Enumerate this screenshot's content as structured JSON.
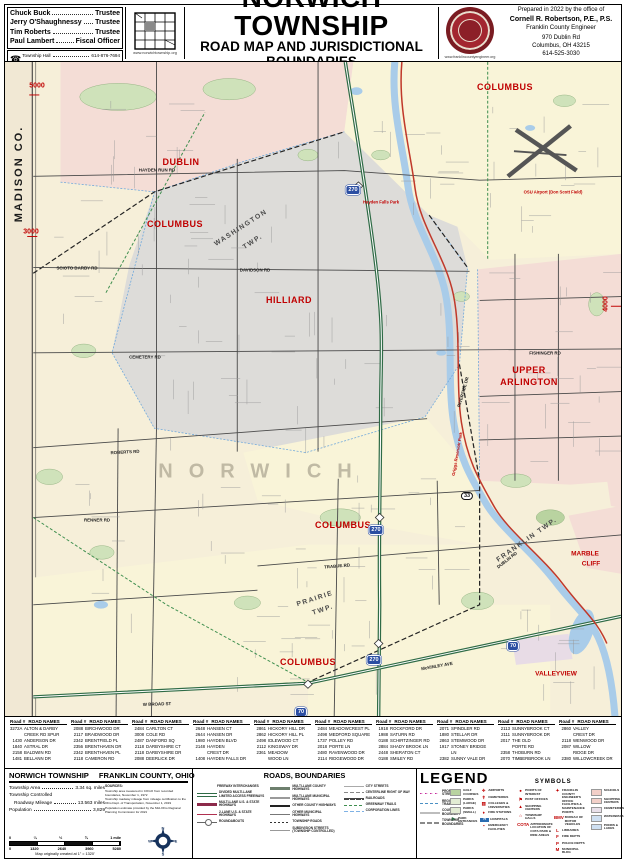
{
  "header": {
    "officials": [
      {
        "name": "Chuck Buck",
        "role": "Trustee"
      },
      {
        "name": "Jerry O'Shaughnessy",
        "role": "Trustee"
      },
      {
        "name": "Tim Roberts",
        "role": "Trustee"
      },
      {
        "name": "Paul Lambert",
        "role": "Fiscal Officer"
      }
    ],
    "contacts": [
      {
        "label": "Township Hall",
        "phone": "614-876-7694"
      },
      {
        "label": "Road Superintendent",
        "phone": "614-876-2238"
      }
    ],
    "phone_icon": "☎",
    "township_site": "www.norwichtownship.org",
    "title": "NORWICH TOWNSHIP",
    "subtitle": "ROAD MAP AND JURISDICTIONAL BOUNDARIES",
    "established": "-  ESTABLISHED 1813  -",
    "prepared": {
      "line1": "Prepared in 2022 by the office of",
      "name": "Cornell R. Robertson, P.E., P.S.",
      "org": "Franklin County Engineer",
      "addr1": "970 Dublin Rd",
      "addr2": "Columbus, OH  43215",
      "phone": "614-525-3030",
      "site": "www.franklincountyengineer.org",
      "seal_text": "FRANKLIN COUNTY ENGINEER"
    }
  },
  "map": {
    "labels": [
      {
        "text": "MADISON CO.",
        "x": 14,
        "y": 112,
        "rot": -90,
        "cls": "county"
      },
      {
        "text": "5000",
        "x": 32,
        "y": 24,
        "cls": "marker"
      },
      {
        "text": "3000",
        "x": 26,
        "y": 170,
        "cls": "marker"
      },
      {
        "text": "4000",
        "x": 601,
        "y": 242,
        "rot": -90,
        "cls": "marker"
      },
      {
        "text": "DUBLIN",
        "x": 176,
        "y": 100,
        "cls": "city"
      },
      {
        "text": "COLUMBUS",
        "x": 170,
        "y": 162,
        "cls": "city"
      },
      {
        "text": "WASHINGTON",
        "x": 236,
        "y": 166,
        "rot": -33,
        "cls": "twp"
      },
      {
        "text": "TWP.",
        "x": 248,
        "y": 180,
        "rot": -33,
        "cls": "twp"
      },
      {
        "text": "COLUMBUS",
        "x": 500,
        "y": 25,
        "cls": "city"
      },
      {
        "text": "HILLIARD",
        "x": 284,
        "y": 238,
        "cls": "city"
      },
      {
        "text": "UPPER",
        "x": 524,
        "y": 308,
        "cls": "city"
      },
      {
        "text": "ARLINGTON",
        "x": 524,
        "y": 320,
        "cls": "city"
      },
      {
        "text": "NORWICH",
        "x": 258,
        "y": 410,
        "cls": "norwich"
      },
      {
        "text": "COLUMBUS",
        "x": 338,
        "y": 463,
        "cls": "city"
      },
      {
        "text": "PRAIRIE",
        "x": 310,
        "y": 537,
        "rot": -18,
        "cls": "twp"
      },
      {
        "text": "TWP.",
        "x": 318,
        "y": 548,
        "rot": -18,
        "cls": "twp"
      },
      {
        "text": "FRANKLIN TWP.",
        "x": 522,
        "y": 478,
        "rot": -35,
        "cls": "twp"
      },
      {
        "text": "COLUMBUS",
        "x": 303,
        "y": 600,
        "cls": "city"
      },
      {
        "text": "MARBLE",
        "x": 580,
        "y": 492,
        "cls": "city-sm"
      },
      {
        "text": "CLIFF",
        "x": 586,
        "y": 502,
        "cls": "city-sm"
      },
      {
        "text": "VALLEYVIEW",
        "x": 551,
        "y": 612,
        "cls": "city-sm"
      },
      {
        "text": "HAYDEN RUN RD",
        "x": 152,
        "y": 108,
        "cls": "road"
      },
      {
        "text": "DAVIDSON RD",
        "x": 250,
        "y": 208,
        "cls": "road"
      },
      {
        "text": "SCIOTO DARBY RD",
        "x": 72,
        "y": 206,
        "cls": "road"
      },
      {
        "text": "CEMETERY RD",
        "x": 140,
        "y": 295,
        "cls": "road"
      },
      {
        "text": "FISHINGER RD",
        "x": 540,
        "y": 291,
        "cls": "road"
      },
      {
        "text": "ROBERTS RD",
        "x": 120,
        "y": 390,
        "rot": -3,
        "cls": "road"
      },
      {
        "text": "RENNER RD",
        "x": 92,
        "y": 458,
        "cls": "road"
      },
      {
        "text": "TRABUE RD",
        "x": 332,
        "y": 504,
        "rot": -5,
        "cls": "road"
      },
      {
        "text": "RIVERSIDE DR",
        "x": 458,
        "y": 330,
        "rot": -74,
        "cls": "road"
      },
      {
        "text": "DUBLIN RD",
        "x": 502,
        "y": 498,
        "rot": -38,
        "cls": "road"
      },
      {
        "text": "McKINLEY AVE",
        "x": 432,
        "y": 604,
        "rot": -10,
        "cls": "road"
      },
      {
        "text": "W BROAD ST",
        "x": 152,
        "y": 642,
        "rot": -2,
        "cls": "road"
      },
      {
        "text": "Hayden Falls Park",
        "x": 376,
        "y": 140,
        "cls": "poi"
      },
      {
        "text": "Griggs Reservoir Park",
        "x": 452,
        "y": 392,
        "rot": -80,
        "cls": "poi"
      },
      {
        "text": "OSU Airport (Don Scott Field)",
        "x": 548,
        "y": 130,
        "cls": "poi"
      },
      {
        "text": "270",
        "x": 348,
        "y": 128,
        "cls": "shield"
      },
      {
        "text": "270",
        "x": 371,
        "y": 468,
        "cls": "shield"
      },
      {
        "text": "270",
        "x": 369,
        "y": 598,
        "cls": "shield"
      },
      {
        "text": "70",
        "x": 296,
        "y": 650,
        "cls": "shield"
      },
      {
        "text": "70",
        "x": 508,
        "y": 584,
        "cls": "shield"
      },
      {
        "text": "33",
        "x": 462,
        "y": 434,
        "cls": "shield-st"
      }
    ]
  },
  "roads": {
    "head_num": "Road #",
    "head_name": "ROAD NAMES",
    "columns": [
      {
        "rows": [
          {
            "n": "3272A",
            "r": "ALTON & DARBY"
          },
          {
            "n": "",
            "r": "CREEK RD SPUR"
          },
          {
            "n": "1430",
            "r": "ANDERSON DR"
          },
          {
            "n": "1840",
            "r": "ASTRAL DR"
          },
          {
            "n": "2158",
            "r": "BALDWIN RD"
          },
          {
            "n": "1481",
            "r": "BELLANN DR"
          }
        ]
      },
      {
        "rows": [
          {
            "n": "2088",
            "r": "BIRCHWOOD DR"
          },
          {
            "n": "2117",
            "r": "BRAIDWOOD DR"
          },
          {
            "n": "2342",
            "r": "BRENTFIELD PL"
          },
          {
            "n": "2356",
            "r": "BRENTHAVEN DR"
          },
          {
            "n": "2342",
            "r": "BRENTHAVEN PL"
          },
          {
            "n": "2118",
            "r": "CAMERON RD"
          }
        ]
      },
      {
        "rows": [
          {
            "n": "2484",
            "r": "CARLTON CT"
          },
          {
            "n": "3008",
            "r": "COLE RD"
          },
          {
            "n": "2487",
            "r": "DANFORD SQ"
          },
          {
            "n": "2118",
            "r": "DARBYSHIRE CT"
          },
          {
            "n": "2118",
            "r": "DARBYSHIRE DR"
          },
          {
            "n": "2088",
            "r": "DEERLICK DR"
          }
        ]
      },
      {
        "rows": [
          {
            "n": "2648",
            "r": "HANSEN CT"
          },
          {
            "n": "2644",
            "r": "HANSEN DR"
          },
          {
            "n": "1980",
            "r": "HAYDEN BLVD"
          },
          {
            "n": "2148",
            "r": "HAYDEN"
          },
          {
            "n": "",
            "r": "CREST DR"
          },
          {
            "n": "1408",
            "r": "HAYDEN FALLS DR"
          }
        ]
      },
      {
        "rows": [
          {
            "n": "2861",
            "r": "HICKORY HILL DR"
          },
          {
            "n": "2862",
            "r": "HICKORY HILL PL"
          },
          {
            "n": "2498",
            "r": "IDLEWOOD CT"
          },
          {
            "n": "2112",
            "r": "KINGSWAY DR"
          },
          {
            "n": "2361",
            "r": "MEADOW"
          },
          {
            "n": "",
            "r": "WOOD LN"
          }
        ]
      },
      {
        "rows": [
          {
            "n": "2484",
            "r": "MEADOWCREST PL"
          },
          {
            "n": "2498",
            "r": "MEDFORD SQUARE"
          },
          {
            "n": "1737",
            "r": "POLLEY RD"
          },
          {
            "n": "2018",
            "r": "PORTE LN"
          },
          {
            "n": "2480",
            "r": "RAVENWOOD DR"
          },
          {
            "n": "2114",
            "r": "RIDGEWOOD DR"
          }
        ]
      },
      {
        "rows": [
          {
            "n": "1918",
            "r": "ROCKFORD DR"
          },
          {
            "n": "1988",
            "r": "SATURN RD"
          },
          {
            "n": "0188",
            "r": "SCHIRTZINGER RD"
          },
          {
            "n": "2884",
            "r": "SHADY BROOK LN"
          },
          {
            "n": "2448",
            "r": "SHERATON CT"
          },
          {
            "n": "0188",
            "r": "SMILEY RD"
          }
        ]
      },
      {
        "rows": [
          {
            "n": "2071",
            "r": "SPINDLER RD"
          },
          {
            "n": "1880",
            "r": "STELLAR DR"
          },
          {
            "n": "2863",
            "r": "STEMWOOD DR"
          },
          {
            "n": "1917",
            "r": "STONEY BRIDGE"
          },
          {
            "n": "",
            "r": "LN"
          },
          {
            "n": "2382",
            "r": "SUNNY VALE DR"
          }
        ]
      },
      {
        "rows": [
          {
            "n": "2113",
            "r": "SUNNYBROOK CT"
          },
          {
            "n": "2111",
            "r": "SUNNYBROOK DR"
          },
          {
            "n": "2017",
            "r": "THE OLD"
          },
          {
            "n": "",
            "r": "PORTE RD"
          },
          {
            "n": "2358",
            "r": "THOBURN RD"
          },
          {
            "n": "2070",
            "r": "TIMBERBROOK LN"
          }
        ]
      },
      {
        "rows": [
          {
            "n": "2860",
            "r": "VALLEY"
          },
          {
            "n": "",
            "r": "CREST DR"
          },
          {
            "n": "2118",
            "r": "WENWOOD DR"
          },
          {
            "n": "2087",
            "r": "WILLOW"
          },
          {
            "n": "",
            "r": "RIDGE DR"
          },
          {
            "n": "2380",
            "r": "WILLOWCREEK DR"
          }
        ]
      }
    ]
  },
  "info": {
    "title_left": "NORWICH TOWNSHIP",
    "title_right": "FRANKLIN COUNTY, OHIO",
    "stats": [
      {
        "label": "Township Area",
        "value": "3.34 sq. miles"
      },
      {
        "label": "Township Controlled",
        "value": "",
        "cls": "nolead"
      },
      {
        "label": "Roadway Mileage",
        "value": "13.563 miles",
        "cls": "indent"
      },
      {
        "label": "Population",
        "value": "3,829"
      }
    ],
    "sources_title": "SOURCES:",
    "sources": [
      {
        "t": "Township area measured in COGO from recorded boundaries, November 1, 1972"
      },
      {
        "t": "Township roadway mileage from mileage certification to the Ohio Dept. of Transportation, November 1, 2019"
      },
      {
        "t": "Population estimate provided by the Mid-Ohio Regional Planning Commission for 2021"
      }
    ],
    "scale": {
      "top": [
        {
          "t": "0"
        },
        {
          "t": "¼"
        },
        {
          "t": "½"
        },
        {
          "t": "¾"
        },
        {
          "t": "1 mile"
        }
      ],
      "bottom": [
        {
          "t": "0"
        },
        {
          "t": "1320"
        },
        {
          "t": "2640"
        },
        {
          "t": "3960"
        },
        {
          "t": "5280"
        }
      ],
      "caption": "Map originally created at 1\" = 1320'"
    },
    "compass": {
      "n": "N",
      "s": "S",
      "e": "E",
      "w": "W"
    }
  },
  "legend": {
    "roads_title": "ROADS, BOUNDARIES",
    "legend_title": "LEGEND",
    "symbols_title": "SYMBOLS",
    "colA": [
      {
        "style": "interchange",
        "label": "FREEWAY INTERCHANGES"
      },
      {
        "style": "freeway",
        "label": "DIVIDED MULTI-LANE LIMITED ACCESS FREEWAYS"
      },
      {
        "style": "us-multi",
        "label": "MULTI-LANE U.S. & STATE HIGHWAYS"
      },
      {
        "style": "us-2lane",
        "label": "2-LANE U.S. & STATE HIGHWAYS"
      },
      {
        "style": "roundabout",
        "label": "ROUNDABOUTS"
      }
    ],
    "colB": [
      {
        "style": "cnty-multi",
        "label": "MULTI-LANE COUNTY HIGHWAYS"
      },
      {
        "style": "muni-multi",
        "label": "MULTI-LANE MUNICIPAL HIGHWAYS"
      },
      {
        "style": "cnty-other",
        "label": "OTHER COUNTY HIGHWAYS"
      },
      {
        "style": "muni-other",
        "label": "OTHER MUNICIPAL HIGHWAYS"
      },
      {
        "style": "twp-road",
        "label": "TOWNSHIP ROADS"
      },
      {
        "style": "subdiv",
        "label": "SUBDIVISION STREETS (TOWNSHIP CONTROLLED)"
      }
    ],
    "colC": [
      {
        "style": "city-street",
        "label": "CITY STREETS"
      },
      {
        "style": "row",
        "label": "CENTERLINE RIGHT OF WAY"
      },
      {
        "style": "railroad",
        "label": "RAILROADS"
      },
      {
        "style": "trail",
        "label": "GREENWAY TRAILS"
      },
      {
        "style": "corp",
        "label": "CORPORATION LINES"
      }
    ],
    "colBounds": [
      {
        "style": "proposed",
        "label": "PROPOSED STREETS"
      },
      {
        "style": "regtrail",
        "label": "REGIONAL TRAIL"
      },
      {
        "style": "cnty-bnd",
        "label": "COUNTY BOUNDARY"
      },
      {
        "style": "twp-bnd",
        "label": "TOWNSHIP BOUNDARIES"
      }
    ],
    "colGreen": [
      {
        "swatch": "#b9d3a0",
        "label": "GOLF COURSES"
      },
      {
        "swatch": "#e2ecd4",
        "label": "PARKS (LARGE)"
      },
      {
        "swatch": "#e2ecd4",
        "label": "PARKS (SMALL)"
      },
      {
        "icon": "▶",
        "iconcls": "green",
        "label": "PARK ENTRANCES"
      }
    ],
    "colPink": [
      {
        "swatch": "#f2cfc8",
        "label": "SCHOOLS"
      },
      {
        "swatch": "#f2cfc8",
        "label": "SHOPPING CENTERS"
      },
      {
        "swatch": "#e9e0ea",
        "label": "CEMETERIES"
      },
      {
        "swatch": "#cfe0f2",
        "label": "WATERWAYS"
      },
      {
        "swatch": "#cfe0f2",
        "label": "PONDS & LAKES"
      }
    ],
    "sym1": [
      {
        "icon": "✈",
        "label": "AIRPORTS"
      },
      {
        "icon": "✝",
        "label": "CEMETERIES"
      },
      {
        "icon": "▥",
        "label": "COLLEGES & UNIVERSITIES"
      },
      {
        "icon": "♦",
        "label": "FIRE STATIONS"
      },
      {
        "icon": "H",
        "iconcls": "hosp",
        "label": "HOSPITALS"
      },
      {
        "icon": "▪",
        "label": "EMERGENCY FACILITIES"
      }
    ],
    "sym2": [
      {
        "icon": "●",
        "label": "POINTS OF INTEREST"
      },
      {
        "icon": "⚑",
        "label": "POST OFFICES"
      },
      {
        "icon": "▲",
        "label": "SHOPPING CENTERS"
      },
      {
        "icon": "⌂",
        "label": "TOWNSHIP HALLS"
      },
      {
        "icon": "COTA",
        "label": "APPROXIMATE LOCATION OF COTA PARK & RIDE AREAS"
      }
    ],
    "sym3": [
      {
        "icon": "✦",
        "label": "FRANKLIN COUNTY ENGINEER'S OFFICE FACILITIES & MAINTENANCE POINTS"
      },
      {
        "icon": "BMV",
        "label": "BUREAU OF MOTOR VEHICLES"
      },
      {
        "icon": "L",
        "label": "LIBRARIES"
      },
      {
        "icon": "F",
        "label": "FIRE DEPTS"
      },
      {
        "icon": "P",
        "label": "POLICE DEPTS"
      },
      {
        "icon": "M",
        "label": "MUNICIPAL BLDG"
      }
    ]
  }
}
